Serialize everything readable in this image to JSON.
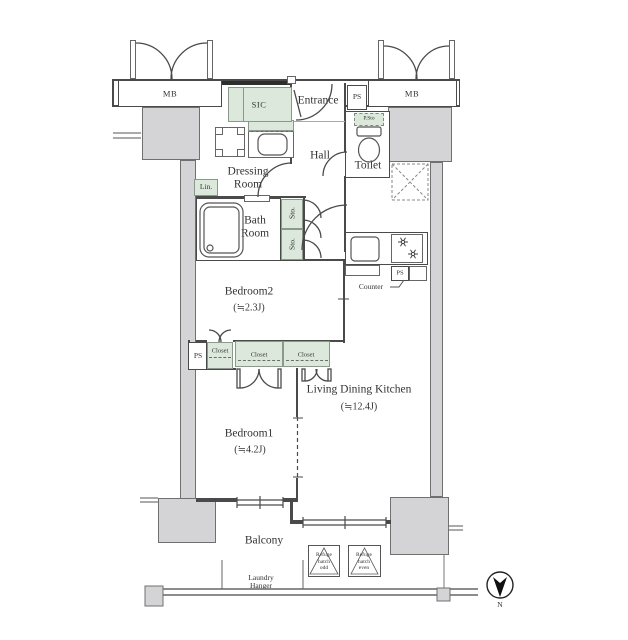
{
  "labels": {
    "mb_left": "MB",
    "mb_right": "MB",
    "sic": "SIC",
    "entrance": "Entrance",
    "ps_top": "PS",
    "p_sto": "P.Sto",
    "toilet": "Toilet",
    "hall": "Hall",
    "dressing": {
      "line1": "Dressing",
      "line2": "Room"
    },
    "lin": "Lin.",
    "bath": {
      "line1": "Bath",
      "line2": "Room"
    },
    "sto_upper": "Sto.",
    "sto_lower": "Sto.",
    "bedroom2": {
      "name": "Bedroom2",
      "size": "(≒2.3J)"
    },
    "ps_mid": "PS",
    "closet_bifold": "Closet",
    "closet_left": "Closet",
    "closet_right": "Closet",
    "ldk": {
      "name": "Living Dining Kitchen",
      "size": "(≒12.4J)"
    },
    "counter": "Counter",
    "ps_kitchen": "PS",
    "bedroom1": {
      "name": "Bedroom1",
      "size": "(≒4.2J)"
    },
    "balcony": "Balcony",
    "laundry": {
      "line1": "Laundry",
      "line2": "Hanger"
    },
    "refuge_odd": {
      "line1": "Refuge",
      "line2": "hatch",
      "line3": "odd"
    },
    "refuge_even": {
      "line1": "Refuge",
      "line2": "hatch",
      "line3": "even"
    },
    "compass": "N"
  },
  "colors": {
    "wall": "#4a4a4a",
    "concrete": "#d4d4d6",
    "storage_green": "#dce8dc",
    "text": "#333333"
  }
}
